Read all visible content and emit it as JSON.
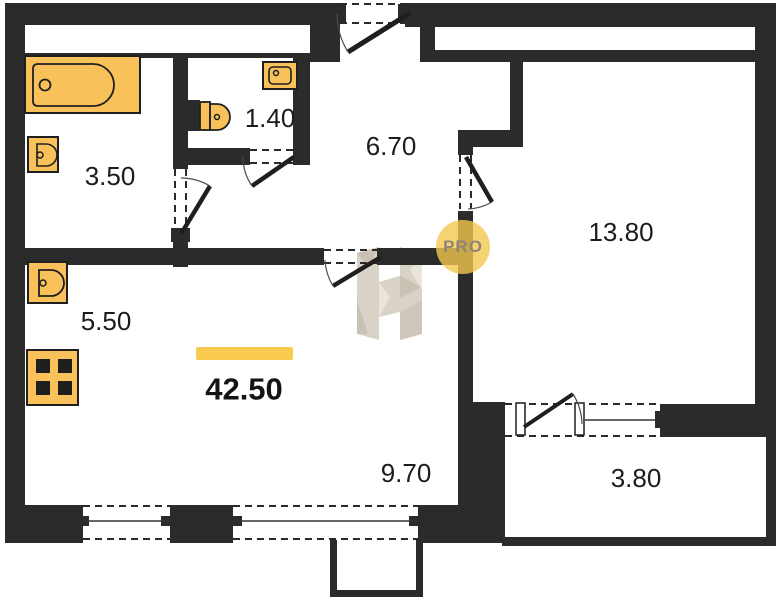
{
  "plan": {
    "title": "apartment-floor-plan",
    "total_area": "42.50",
    "rooms": [
      {
        "id": "bathroom",
        "area": "3.50"
      },
      {
        "id": "wc",
        "area": "1.40"
      },
      {
        "id": "hallway",
        "area": "6.70"
      },
      {
        "id": "bedroom",
        "area": "13.80"
      },
      {
        "id": "kitchen",
        "area": "5.50"
      },
      {
        "id": "living-zone",
        "area": "9.70"
      },
      {
        "id": "balcony",
        "area": "3.80"
      }
    ],
    "watermark": {
      "badge": "PRO"
    },
    "fixtures": [
      "bathtub",
      "bathroom-sink",
      "toilet",
      "wc-sink",
      "kitchen-sink",
      "stove"
    ],
    "colors": {
      "wall": "#2b2b2b",
      "fixture_fill": "#f8c159",
      "outline": "#1f1f1f",
      "highlight": "#f9cb4f",
      "watermark_letter": "#d7d0c4",
      "watermark_badge": "#f4c84f",
      "badge_text": "#8e8478"
    }
  }
}
